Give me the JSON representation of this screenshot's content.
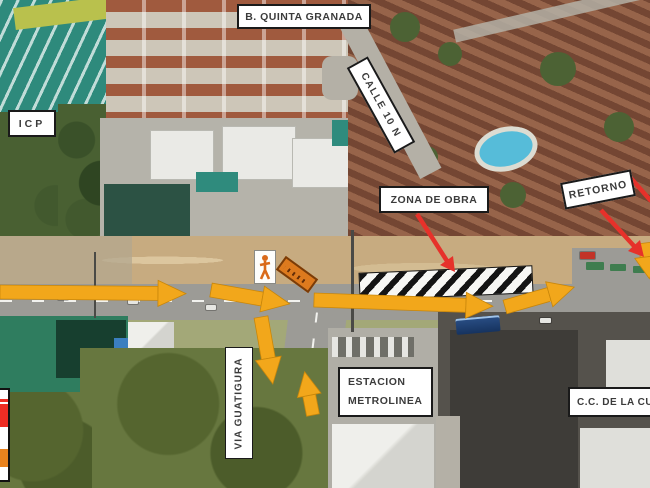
{
  "map": {
    "area_labels": {
      "quinta_granada": "B. QUINTA GRANADA",
      "icp": "ICP",
      "calle_10n": "CALLE 10 N",
      "zona_de_obra": "ZONA DE OBRA",
      "retorno": "RETORNO",
      "estacion_line1": "ESTACION",
      "estacion_line2": "METROLINEA",
      "centro_comercial": "C.C. DE LA CUE",
      "via_guatigura": "VIA GUATIGURA"
    },
    "colors": {
      "route_arrow": "#F2A71B",
      "callout_arrow": "#E6312A",
      "label_border": "#1A1A1A",
      "label_text": "#3B3B3B",
      "work_zone_hatch": "#141414",
      "detour_sign_orange": "#DD7A1E",
      "worker_sign_figure": "#D96A1A",
      "legend_red": "#EE2D24",
      "legend_orange": "#E8821E"
    }
  }
}
